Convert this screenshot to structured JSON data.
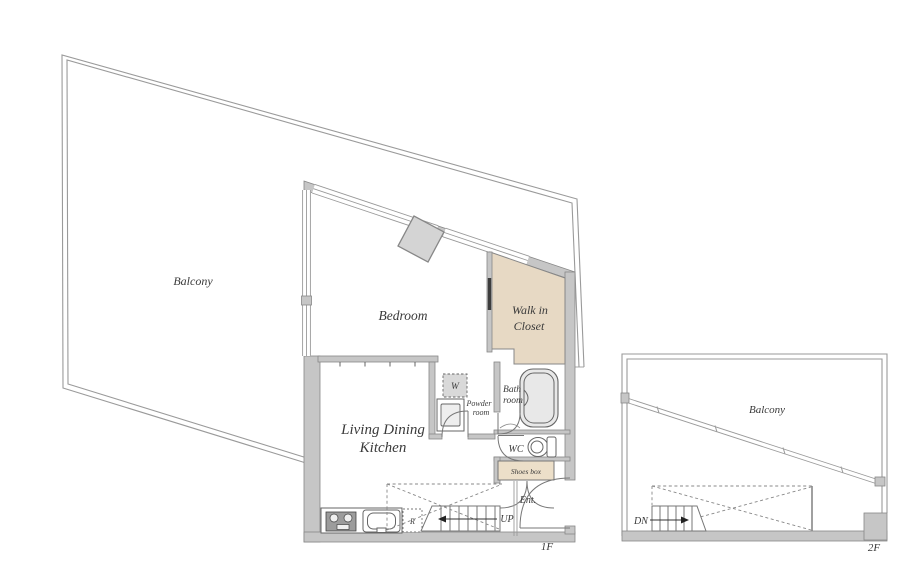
{
  "colors": {
    "wall_fill": "#c6c6c6",
    "wall_stroke": "#878787",
    "line_color": "#9a9a9a",
    "closet_fill": "#e7d9c4",
    "shoes_fill": "#ecdfc9",
    "pillar_fill": "#d4d4d4",
    "fixture_stroke": "#666666",
    "text_color": "#3a3a3a",
    "dash_color": "#888888",
    "accent_dark": "#3d3d3d"
  },
  "floor1": {
    "floor_label": "1F",
    "balcony_label": "Balcony",
    "bedroom_label": "Bedroom",
    "walk_in_closet_label": [
      "Walk in",
      "Closet"
    ],
    "ldk_label": [
      "Living Dining",
      "Kitchen"
    ],
    "powder_room_label": [
      "Powder",
      "room"
    ],
    "bath_room_label": [
      "Bath",
      "room"
    ],
    "washer_label": "W",
    "wc_label": "WC",
    "shoes_box_label": "Shoes box",
    "entrance_label": "Ent.",
    "up_label": "UP",
    "refrigerator_label": "R"
  },
  "floor2": {
    "floor_label": "2F",
    "balcony_label": "Balcony",
    "down_label": "DN"
  }
}
